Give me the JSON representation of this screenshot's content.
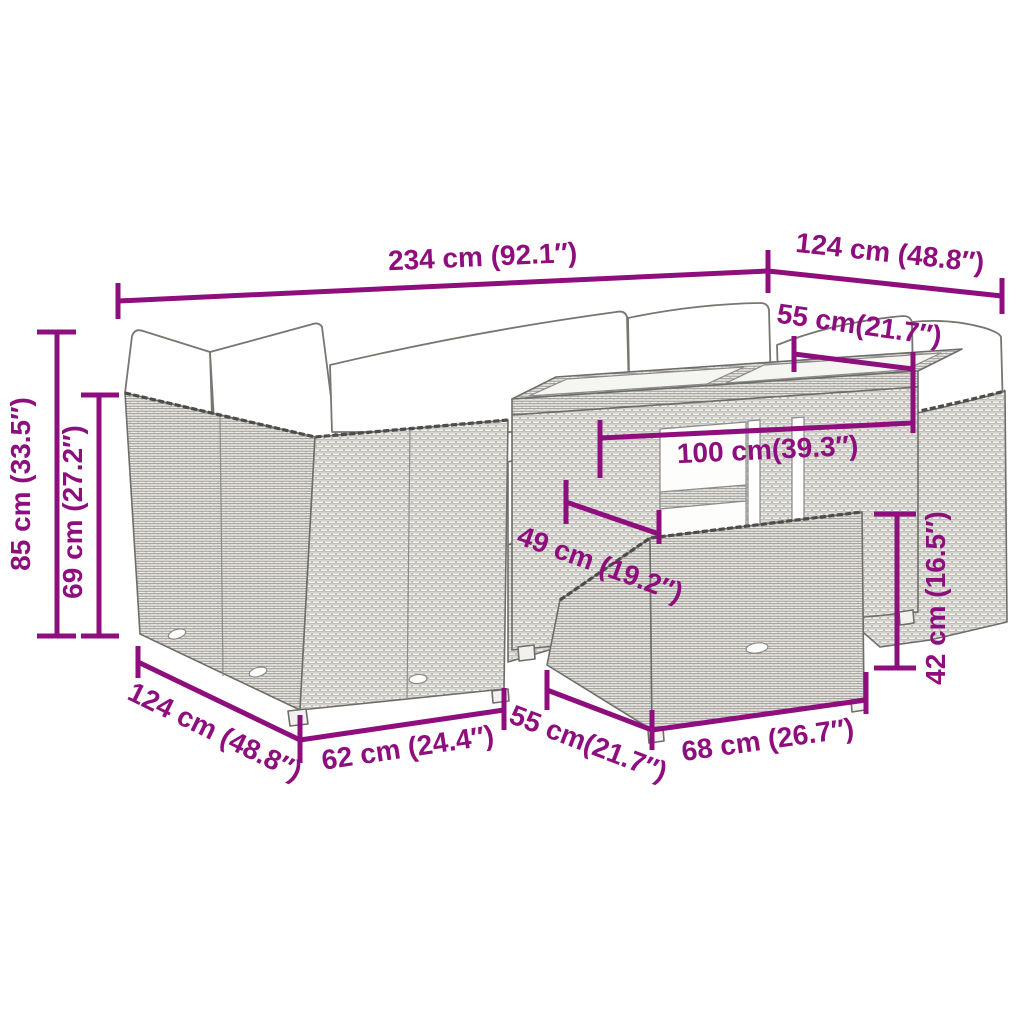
{
  "diagram": {
    "type": "product-dimension-diagram",
    "background": "#ffffff"
  },
  "colors": {
    "dimension_magenta": "#8E0E7D",
    "line_art_gray": "#6f6d6a",
    "cushion_white": "#ffffff"
  },
  "dims": {
    "overall_width": "234 cm (92.1″)",
    "depth_right": "124 cm (48.8″)",
    "right_seat_width": "55 cm(21.7″)",
    "total_height": "85 cm (33.5″)",
    "backrest_height": "69 cm (27.2″)",
    "table_width": "100 cm(39.3″)",
    "table_depth": "49 cm (19.2″)",
    "ottoman_height": "42 cm (16.5″)",
    "depth_left": "124 cm (48.8″)",
    "left_seat_width": "62 cm (24.4″)",
    "ottoman_depth": "55 cm(21.7″)",
    "ottoman_width": "68 cm (26.7″)"
  }
}
